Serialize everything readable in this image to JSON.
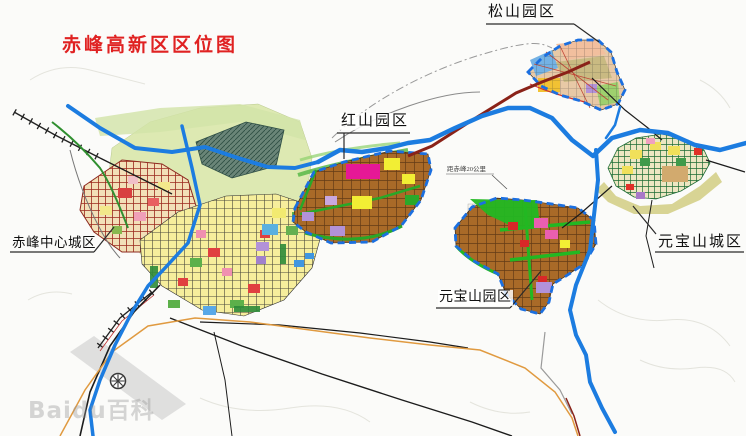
{
  "title": {
    "text": "赤峰高新区区位图",
    "color": "#e02222"
  },
  "labels": [
    {
      "id": "songshan-park",
      "text": "松山园区"
    },
    {
      "id": "hongshan-park",
      "text": "红山园区"
    },
    {
      "id": "chifeng-center-city",
      "text": "赤峰中心城区"
    },
    {
      "id": "yuanbaoshan-park",
      "text": "元宝山园区"
    },
    {
      "id": "yuanbaoshan-city",
      "text": "元宝山城区"
    }
  ],
  "annotations": [
    {
      "id": "distance-note",
      "text": "距赤峰20公里"
    }
  ],
  "watermark": {
    "text": "Baidu百科"
  },
  "map_colors": {
    "title_red": "#e02222",
    "river_blue": "#1c7ce0",
    "park_boundary_blue": "#1b6fe0",
    "industrial_brown": "#a96a28",
    "city_yellow": "#f6ee9c",
    "old_town_red_grid": "#9c2a1e",
    "green_space": "#22b822",
    "main_road_dark_red": "#8a2218",
    "secondary_road_orange": "#e09a40",
    "songshan_peach": "#e8c9a6",
    "ybs_city_khaki": "#d6d28e"
  }
}
